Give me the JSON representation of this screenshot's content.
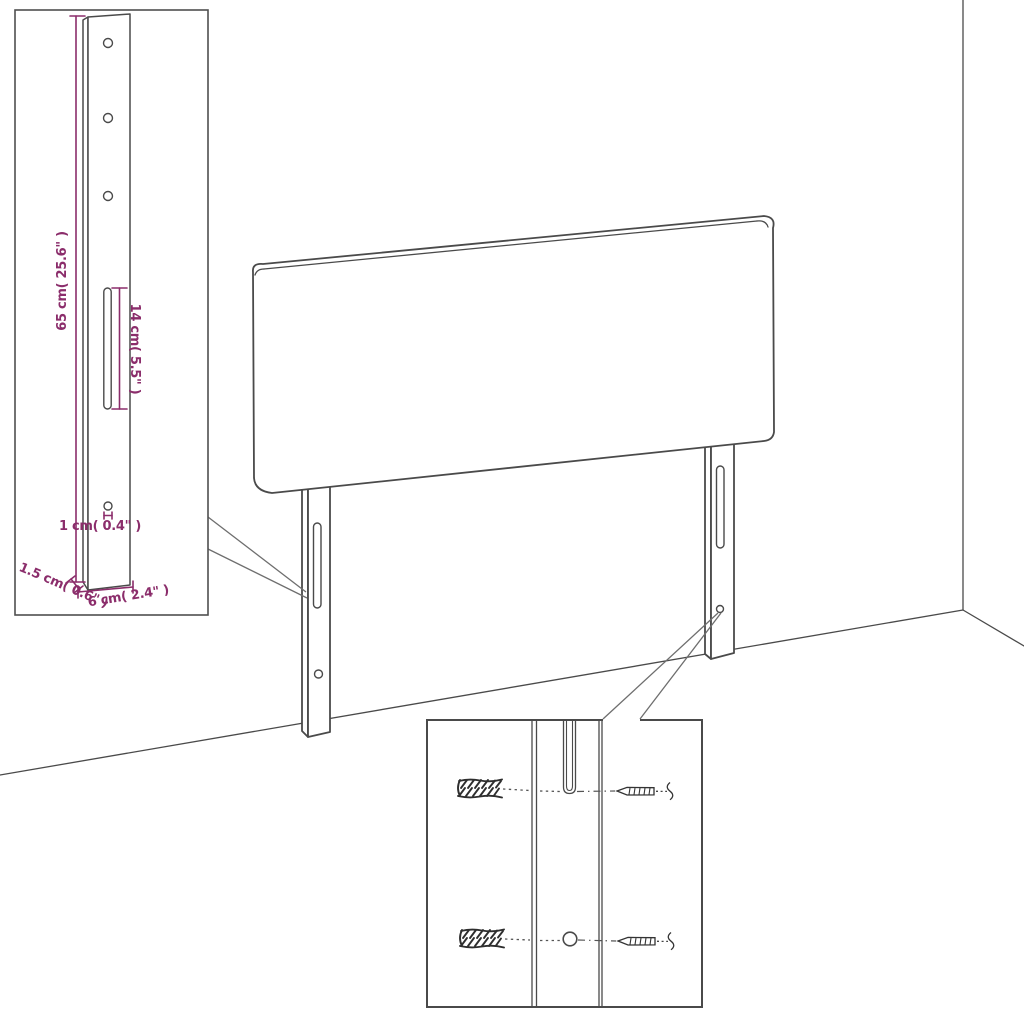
{
  "colors": {
    "dimension": "#8B2D6B",
    "drawing_line": "#4A4A4A",
    "background": "#FFFFFF"
  },
  "bracket_detail": {
    "dim_height": "65 cm( 25.6\" )",
    "dim_slot_length": "14 cm( 5.5\" )",
    "dim_hole": "1 cm( 0.4\" )",
    "dim_thickness": "1.5 cm( 0.6\" )",
    "dim_width": "6 cm( 2.4\" )"
  }
}
